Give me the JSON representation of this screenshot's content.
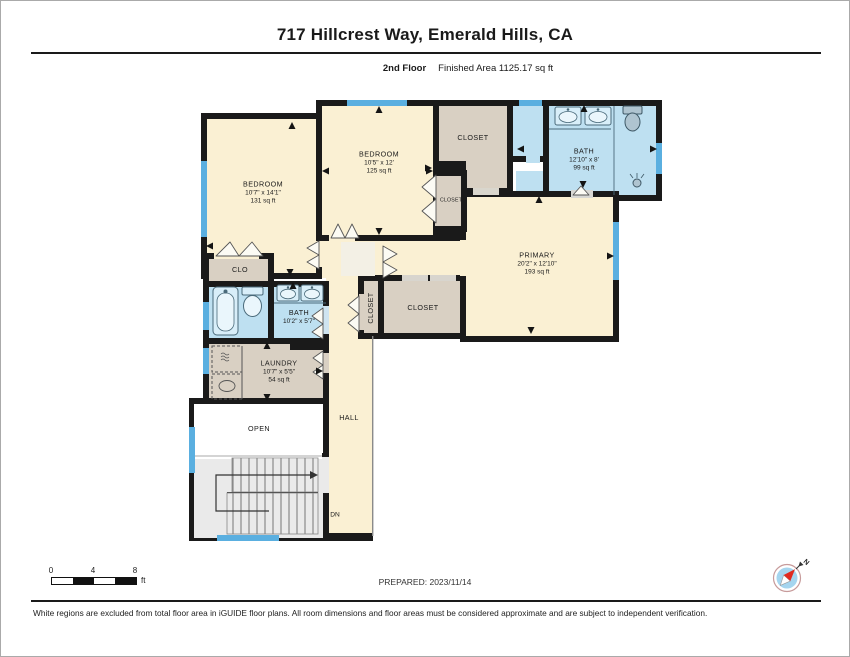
{
  "header": {
    "title": "717 Hillcrest Way, Emerald Hills, CA",
    "floor": "2nd Floor",
    "area": "Finished Area 1125.17 sq ft"
  },
  "rooms": {
    "bedroom1": {
      "name": "BEDROOM",
      "dims": "10'7\" x 14'1\"",
      "area": "131 sq ft"
    },
    "bedroom2": {
      "name": "BEDROOM",
      "dims": "10'5\" x 12'",
      "area": "125 sq ft"
    },
    "closet_top": {
      "name": "CLOSET"
    },
    "bath_main": {
      "name": "BATH",
      "dims": "12'10\" x 8'",
      "area": "99 sq ft"
    },
    "closet_small": {
      "name": "CLOSET"
    },
    "primary": {
      "name": "PRIMARY",
      "dims": "20'2\" x 12'10\"",
      "area": "193 sq ft"
    },
    "clo": {
      "name": "CLO"
    },
    "bath2": {
      "name": "BATH",
      "dims": "10'2\" x 5'7\""
    },
    "closet_vert": {
      "name": "CLOSET"
    },
    "closet_center": {
      "name": "CLOSET"
    },
    "laundry": {
      "name": "LAUNDRY",
      "dims": "10'7\" x 5'5\"",
      "area": "54 sq ft"
    },
    "hall": {
      "name": "HALL"
    },
    "open": {
      "name": "OPEN"
    },
    "dn": {
      "label": "DN"
    }
  },
  "scalebar": {
    "t0": "0",
    "t4": "4",
    "t8": "8",
    "unit": "ft"
  },
  "compass": {
    "north": "N"
  },
  "footer": {
    "prepared": "PREPARED: 2023/11/14",
    "disclaimer": "White regions are excluded from total floor area in iGUIDE floor plans. All room dimensions and floor areas must be considered approximate and are subject to independent verification."
  },
  "colors": {
    "room_tan": "#FAF0D3",
    "closet_gray": "#D9D0C3",
    "bath_blue": "#BEE0F1",
    "fixture_light": "#D8EEF9",
    "window_blue": "#5AAFE0",
    "wall": "#1A1A1A",
    "stairs_gray": "#EAEAEA",
    "compass_blue": "#A5D5EF",
    "compass_red": "#E02A20"
  }
}
